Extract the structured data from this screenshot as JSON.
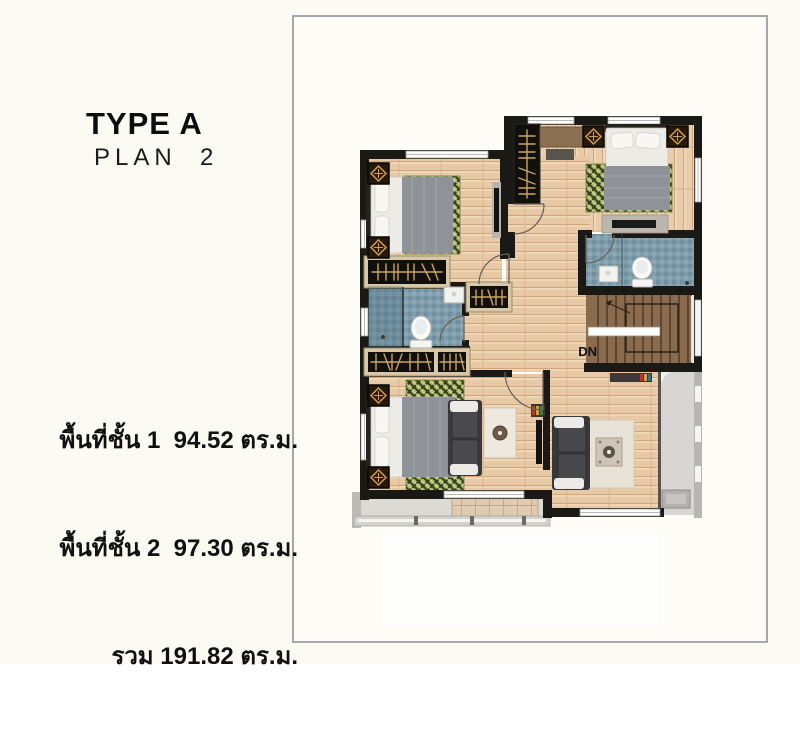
{
  "header": {
    "title": "TYPE A",
    "subtitle": "PLAN  2"
  },
  "areas": {
    "line1": "พื้นที่ชั้น 1  94.52 ตร.ม.",
    "line2": "พื้นที่ชั้น 2  97.30 ตร.ม.",
    "line3": "รวม 191.82 ตร.ม."
  },
  "plan": {
    "dn_label": "DN"
  },
  "colors": {
    "background": "#fcfbf3",
    "frame_border": "#a7a7a7",
    "wall": "#1b1916",
    "wood_floor": "#e7c9a6",
    "wood_grain": "#cfa67e",
    "bath_tile": "#7f9dab",
    "stair_wood": "#8a6b4e",
    "rug_green": "#aab869",
    "rug_plaid": "#353e1c",
    "balcony_deck": "#dbdad5",
    "terrace_tile": "#e0cbb0",
    "closet_black": "#12100d",
    "hanger_gold": "#c9a55f",
    "text": "#111111"
  }
}
